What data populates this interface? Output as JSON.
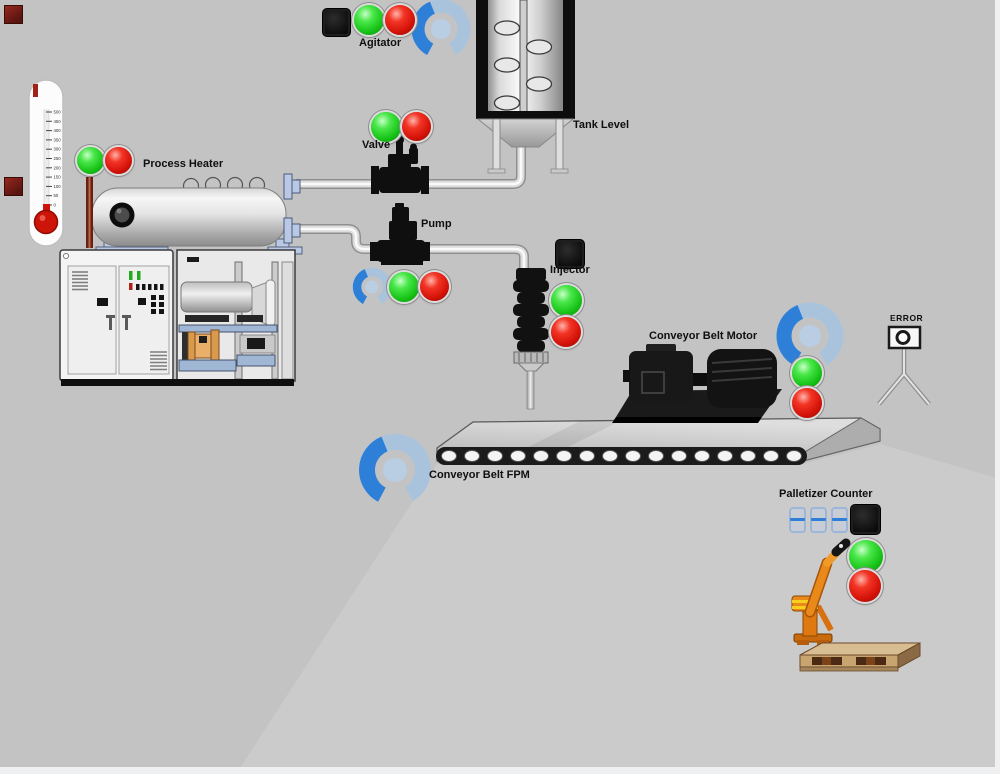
{
  "screen": {
    "background": "#c3c3c4"
  },
  "colors": {
    "light_green": "#16c216",
    "light_red": "#d31208",
    "gauge_active_blue": "#2e7fd8",
    "gauge_track_blue": "#a9c3dd",
    "pipe_gray": "#d9d9d9",
    "robot_orange": "#e8891a",
    "pallet_wood": "#c8a470"
  },
  "thermometer": {
    "ticks": [
      "500",
      "450",
      "400",
      "350",
      "300",
      "250",
      "200",
      "150",
      "100",
      "50",
      "0"
    ]
  },
  "components": {
    "agitator": {
      "label": "Agitator"
    },
    "tank": {
      "label": "Tank Level"
    },
    "process_heater": {
      "label": "Process Heater"
    },
    "valve": {
      "label": "Valve"
    },
    "pump": {
      "label": "Pump"
    },
    "injector": {
      "label": "Injector"
    },
    "conveyor_motor": {
      "label": "Conveyor Belt Motor"
    },
    "conveyor_fpm": {
      "label": "Conveyor Belt FPM"
    },
    "error_camera": {
      "label": "ERROR"
    },
    "palletizer": {
      "label": "Palletizer Counter",
      "counter_display": "888"
    }
  }
}
